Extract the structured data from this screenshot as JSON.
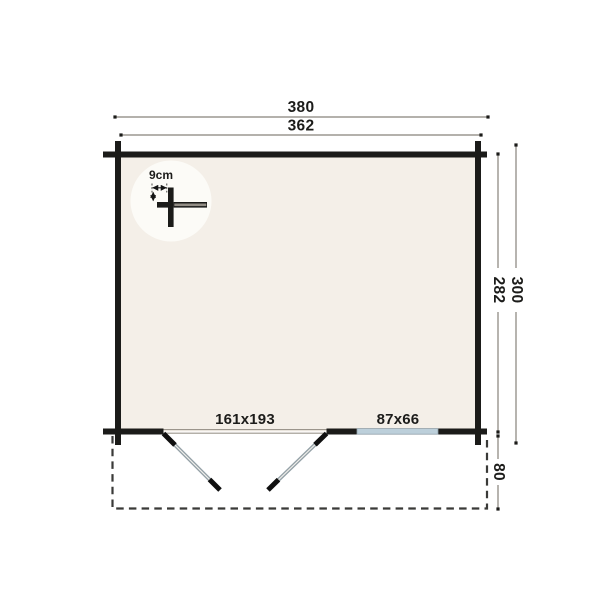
{
  "plan": {
    "dimensions": {
      "outer_width": "380",
      "inner_width": "362",
      "outer_height": "300",
      "inner_height": "282",
      "terrace_depth": "80"
    },
    "openings": {
      "door_label": "161x193",
      "window_label": "87x66"
    },
    "wall_detail": {
      "thickness_label": "9cm"
    },
    "colors": {
      "wall": "#1b1b19",
      "floor": "#f4efe8",
      "detail_circle": "#fcfbf7",
      "window_glass": "#bccfda",
      "dimension_line": "#87827a",
      "door_leaf": "#94a1a7",
      "terrace_outline": "#3a3a38"
    }
  }
}
